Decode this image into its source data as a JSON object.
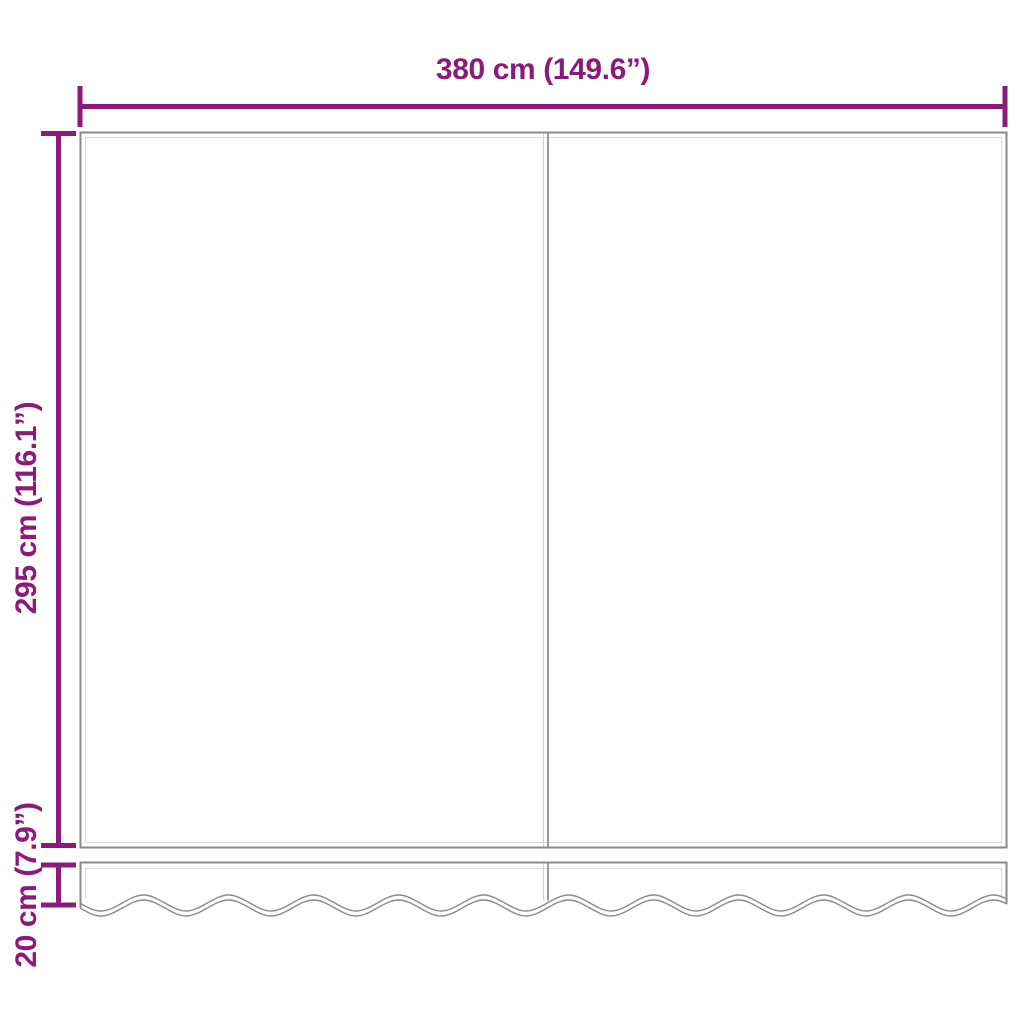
{
  "labels": {
    "width": "380 cm (149.6”)",
    "height": "295 cm (116.1”)",
    "valance_height": "20 cm (7.9”)"
  },
  "colors": {
    "dimension_accent": "#8c1a7b",
    "outline_gray": "#8a8a8a",
    "inner_line_gray": "#d8d8d8",
    "seam_gray": "#9a9a9a",
    "background": "#ffffff"
  },
  "diagram": {
    "panels": 2,
    "has_valance_wave_edge": true
  }
}
